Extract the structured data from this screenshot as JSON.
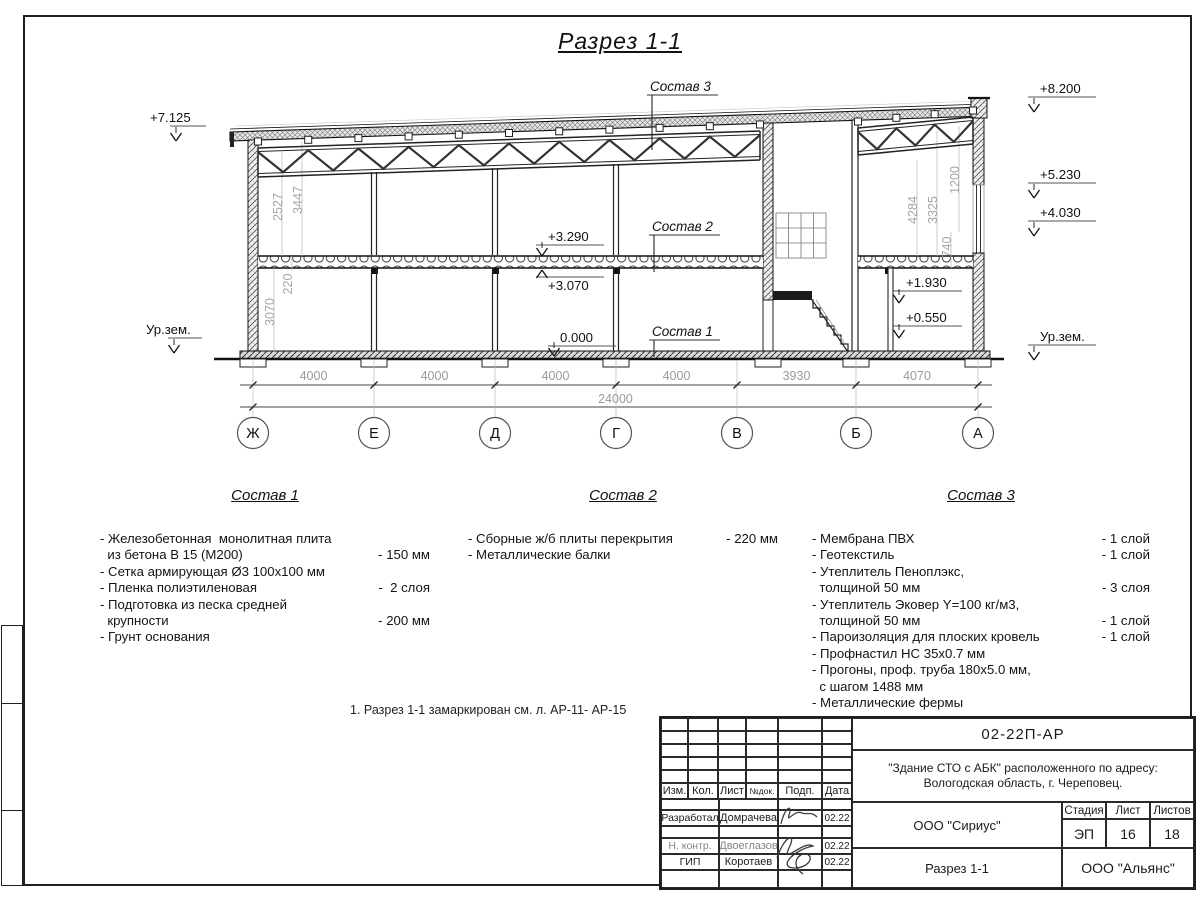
{
  "colors": {
    "ink": "#1b1b1b",
    "dim_text": "#9a9a9a"
  },
  "sheet": {
    "title": "Разрез 1-1",
    "note": "1. Разрез 1-1 замаркирован см. л. АР-11- АР-15"
  },
  "drawing": {
    "axes": [
      {
        "label": "Ж",
        "x": 253
      },
      {
        "label": "Е",
        "x": 374
      },
      {
        "label": "Д",
        "x": 495
      },
      {
        "label": "Г",
        "x": 616
      },
      {
        "label": "В",
        "x": 737
      },
      {
        "label": "Б",
        "x": 856
      },
      {
        "label": "А",
        "x": 978
      }
    ],
    "span_dims": [
      "4000",
      "4000",
      "4000",
      "4000",
      "3930",
      "4070"
    ],
    "total_dim": "24000",
    "levels": [
      {
        "label": "+7.125",
        "tx": 150,
        "ty": 122,
        "ax": 176,
        "ay": 141,
        "over": false
      },
      {
        "label": "+8.200",
        "tx": 1040,
        "ty": 93,
        "ax": 1034,
        "ay": 112,
        "over": false
      },
      {
        "label": "+5.230",
        "tx": 1040,
        "ty": 179,
        "ax": 1034,
        "ay": 198,
        "over": false
      },
      {
        "label": "+4.030",
        "tx": 1040,
        "ty": 217,
        "ax": 1034,
        "ay": 236,
        "over": false
      },
      {
        "label": "Ур.зем.",
        "tx": 146,
        "ty": 334,
        "ax": 174,
        "ay": 353,
        "over": false
      },
      {
        "label": "Ур.зем.",
        "tx": 1040,
        "ty": 341,
        "ax": 1034,
        "ay": 360,
        "over": false
      },
      {
        "label": "+3.290",
        "tx": 548,
        "ty": 241,
        "ax": 542,
        "ay": 256,
        "over": false
      },
      {
        "label": "+3.070",
        "tx": 548,
        "ty": 290,
        "ax": 542,
        "ay": 270,
        "over": true
      },
      {
        "label": "0.000",
        "tx": 560,
        "ty": 342,
        "ax": 554,
        "ay": 356,
        "over": false
      },
      {
        "label": "+1.930",
        "tx": 906,
        "ty": 287,
        "ax": 899,
        "ay": 303,
        "over": false
      },
      {
        "label": "+0.550",
        "tx": 906,
        "ty": 322,
        "ax": 899,
        "ay": 338,
        "over": false
      }
    ],
    "vdims": [
      {
        "label": "2527",
        "x": 282,
        "y": 207
      },
      {
        "label": "3447",
        "x": 302,
        "y": 200
      },
      {
        "label": "220",
        "x": 292,
        "y": 284
      },
      {
        "label": "3070",
        "x": 274,
        "y": 312
      },
      {
        "label": "4284",
        "x": 917,
        "y": 210
      },
      {
        "label": "3325",
        "x": 937,
        "y": 210
      },
      {
        "label": "1200",
        "x": 959,
        "y": 180
      },
      {
        "label": "740",
        "x": 951,
        "y": 247
      }
    ],
    "callouts": [
      {
        "label": "Состав 3",
        "x": 650,
        "y": 91,
        "ly": 150
      },
      {
        "label": "Состав 2",
        "x": 652,
        "y": 231,
        "ly": 272
      },
      {
        "label": "Состав 1",
        "x": 652,
        "y": 336,
        "ly": 357
      }
    ]
  },
  "compositions": [
    {
      "title": "Состав 1",
      "rows": [
        [
          "- Железобетонная  монолитная плита",
          ""
        ],
        [
          "  из бетона В 15 (М200)",
          "- 150 мм"
        ],
        [
          "- Сетка армирующая Ø3 100x100 мм",
          ""
        ],
        [
          "- Пленка полиэтиленовая",
          "-  2 слоя"
        ],
        [
          "- Подготовка из песка средней",
          ""
        ],
        [
          "  крупности",
          "- 200 мм"
        ],
        [
          "- Грунт основания",
          ""
        ]
      ]
    },
    {
      "title": "Состав 2",
      "rows": [
        [
          "- Сборные ж/б плиты перекрытия",
          "- 220 мм"
        ],
        [
          "- Металлические балки",
          ""
        ]
      ]
    },
    {
      "title": "Состав 3",
      "rows": [
        [
          "- Мембрана ПВХ",
          "- 1 слой"
        ],
        [
          "- Геотекстиль",
          "- 1 слой"
        ],
        [
          "- Утеплитель Пеноплэкс,",
          ""
        ],
        [
          "  толщиной 50 мм",
          "- 3 слоя"
        ],
        [
          "- Утеплитель Эковер Y=100 кг/м3,",
          ""
        ],
        [
          "  толщиной 50 мм",
          "- 1 слой"
        ],
        [
          "- Пароизоляция для плоских кровель",
          "- 1 слой"
        ],
        [
          "- Профнастил НС 35x0.7 мм",
          ""
        ],
        [
          "- Прогоны, проф. труба 180x5.0 мм,",
          ""
        ],
        [
          "  с шагом 1488 мм",
          ""
        ],
        [
          "- Металлические фермы",
          ""
        ]
      ]
    }
  ],
  "titleblock": {
    "doc_number": "02-22П-АР",
    "project_line1": "\"Здание СТО с АБК\" расположенного по адресу:",
    "project_line2": "Вологодская область, г. Череповец.",
    "header_cells": [
      "Изм.",
      "Кол.",
      "Лист",
      "№док.",
      "Подп.",
      "Дата"
    ],
    "rows": [
      {
        "role": "Разработал",
        "name": "Домрачева",
        "date": "02.22",
        "muted": false
      },
      {
        "role": "Н. контр.",
        "name": "Двоеглазов",
        "date": "02.22",
        "muted": true
      },
      {
        "role": "ГИП",
        "name": "Коротаев",
        "date": "02.22",
        "muted": false
      }
    ],
    "org1": "ООО \"Сириус\"",
    "org2": "ООО \"Альянс\"",
    "stage_header": [
      "Стадия",
      "Лист",
      "Листов"
    ],
    "stage": "ЭП",
    "sheet_no": "16",
    "sheets_total": "18",
    "drawing_name": "Разрез 1-1"
  }
}
